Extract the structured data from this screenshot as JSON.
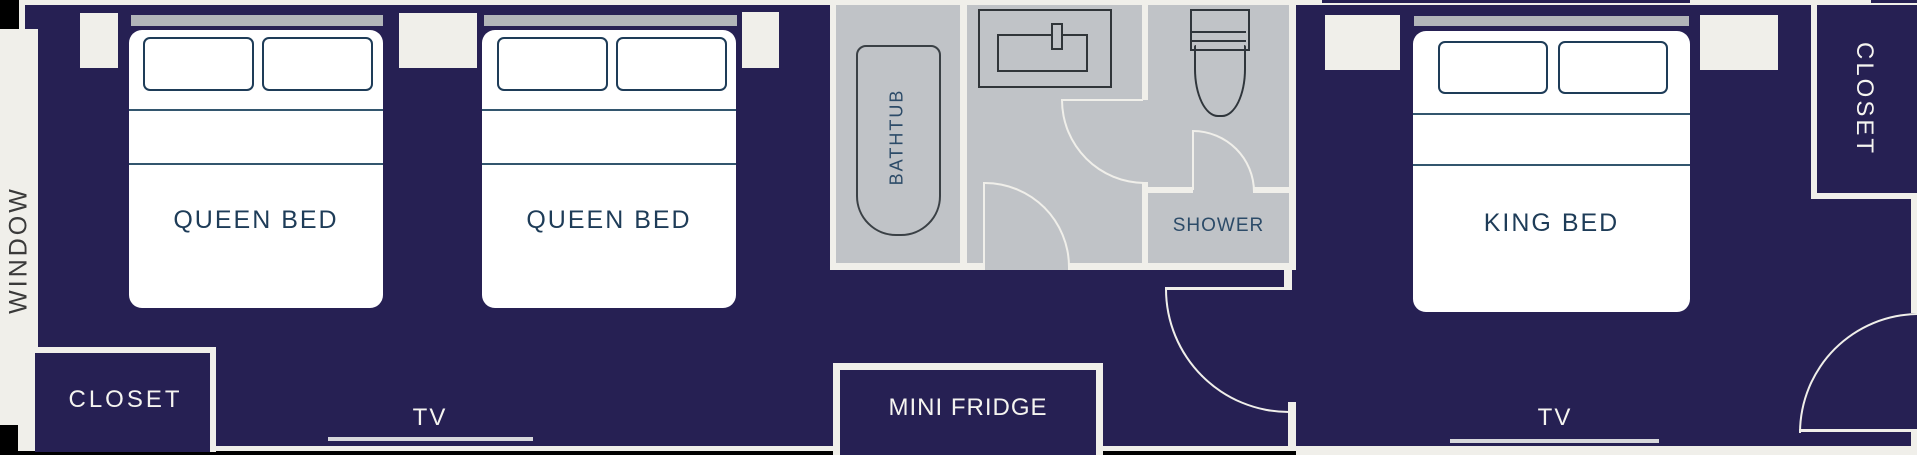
{
  "title": "hotel-room-floor-plan",
  "colors": {
    "navy": "#262053",
    "off_white": "#f0efea",
    "bathroom_gray": "#c0c3c7",
    "headboard_gray": "#b1b5b9",
    "bed_white": "#ffffff",
    "dark_text": "#1e3c58",
    "bath_text": "#2c4b68",
    "window_text": "#3a3a3a",
    "tv_line": "#d6d7db",
    "fixture_outline": "#3a4045",
    "corner_black": "#000000"
  },
  "left_room": {
    "window_label": "WINDOW",
    "beds": [
      {
        "label": "QUEEN BED"
      },
      {
        "label": "QUEEN BED"
      }
    ],
    "closet_label": "CLOSET",
    "tv_label": "TV"
  },
  "bathroom": {
    "bathtub_label": "BATHTUB",
    "shower_label": "SHOWER"
  },
  "hallway": {
    "fridge_label": "MINI FRIDGE"
  },
  "right_room": {
    "bed_label": "KING BED",
    "closet_label": "CLOSET",
    "tv_label": "TV"
  }
}
